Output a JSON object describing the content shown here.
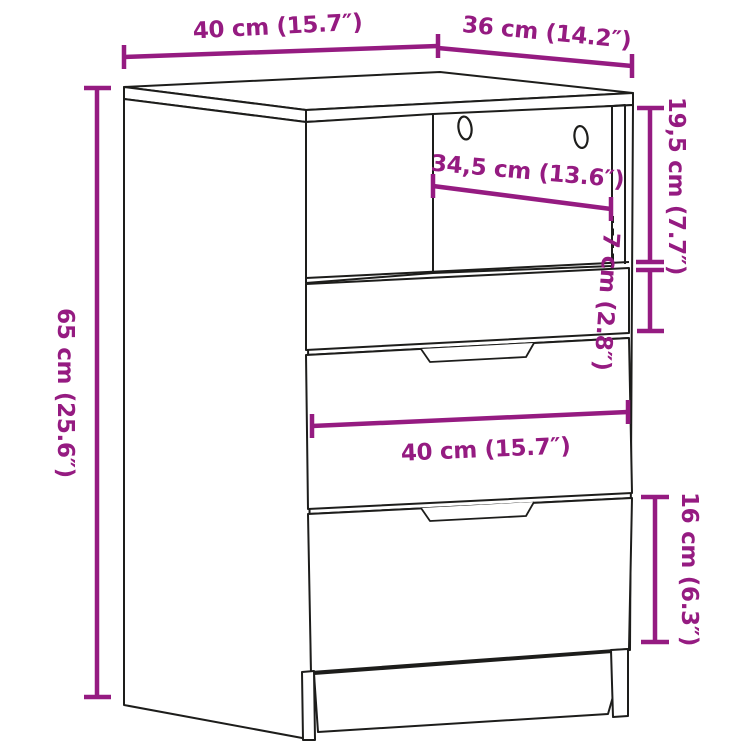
{
  "diagram": {
    "kind": "furniture-dimension-diagram",
    "subject": "chest of drawers with open top compartment, three drawers and plinth feet",
    "colors": {
      "dimension_color": "#951b81",
      "line_art_color": "#1d1d1b",
      "background": "#ffffff"
    },
    "dims": {
      "top_width": "40 cm (15.7″)",
      "top_depth": "36 cm (14.2″)",
      "height": "65 cm (25.6″)",
      "compartment_height": "19,5 cm (7.7″)",
      "compartment_width": "34,5 cm (13.6″)",
      "small_drawer_height": "7 cm (2.8″)",
      "drawer_width": "40 cm (15.7″)",
      "bottom_drawer_height": "16 cm (6.3″)"
    }
  }
}
